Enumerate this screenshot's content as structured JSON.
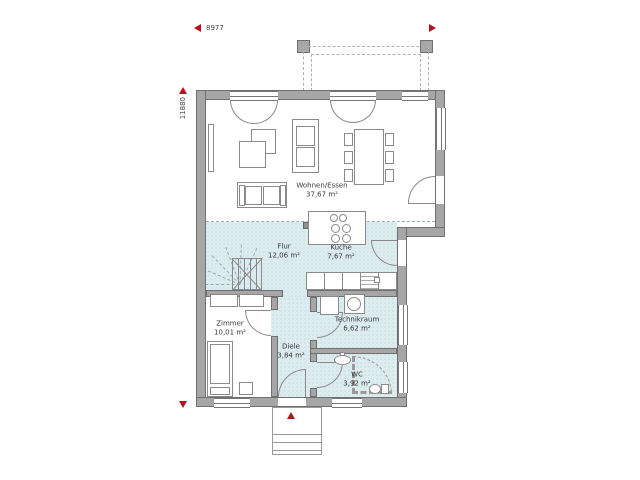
{
  "annotations": {
    "width": "8977",
    "height": "11880"
  },
  "rooms": [
    {
      "name": "Wohnen/Essen",
      "area": "37,67 m²"
    },
    {
      "name": "Flur",
      "area": "12,06 m²"
    },
    {
      "name": "Küche",
      "area": "7,67 m²"
    },
    {
      "name": "Zimmer",
      "area": "10,01 m²"
    },
    {
      "name": "Diele",
      "area": "3,84 m²"
    },
    {
      "name": "Technikraum",
      "area": "6,62 m²"
    },
    {
      "name": "WC",
      "area": "3,92 m²"
    }
  ],
  "colors": {
    "wall_fill": "#a6a6a6",
    "wall_outline": "#707070",
    "tile_floor": "#dcecef",
    "tile_dot": "#b3cfd6",
    "marker_red": "#b5121b",
    "drawing_line": "#8a8a8a",
    "label_text": "#3a3a3a"
  }
}
